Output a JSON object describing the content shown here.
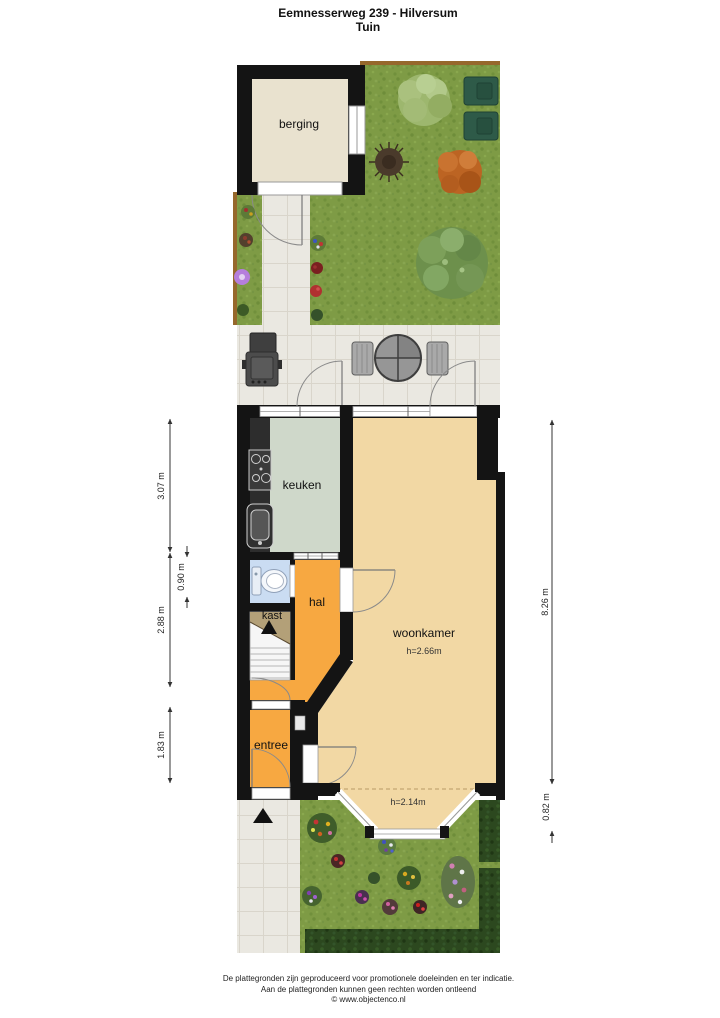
{
  "title": {
    "line1": "Eemnesserweg 239 - Hilversum",
    "line2": "Tuin"
  },
  "rooms": {
    "berging": {
      "label": "berging"
    },
    "keuken": {
      "label": "keuken"
    },
    "kast": {
      "label": "kast"
    },
    "hal": {
      "label": "hal"
    },
    "woonkamer": {
      "label": "woonkamer",
      "ceiling_height": "h=2.66m"
    },
    "entree": {
      "label": "entree"
    },
    "erker": {
      "ceiling_height": "h=2.14m"
    }
  },
  "dimensions": {
    "left": [
      {
        "label": "3.07 m"
      },
      {
        "label": "0.90 m"
      },
      {
        "label": "2.88 m"
      },
      {
        "label": "1.83 m"
      }
    ],
    "right": [
      {
        "label": "8.26 m"
      },
      {
        "label": "0.82 m"
      }
    ]
  },
  "footer": {
    "line1": "De plattegronden zijn geproduceerd voor promotionele doeleinden en ter indicatie.",
    "line2": "Aan de plattegronden kunnen geen rechten worden ontleend",
    "line3": "© www.objectenco.nl"
  },
  "colors": {
    "wall": "#141414",
    "grass": "#7e9b45",
    "tile": "#eae8e1",
    "berging_floor": "#e9e2cf",
    "keuken_floor": "#cfd8ca",
    "woonkamer_floor": "#f2d8a4",
    "hal_floor": "#f7a841",
    "toilet_floor": "#cadcf2",
    "kast_fill": "#b3a078",
    "hedge": "#2c481f",
    "fence": "#96682c"
  }
}
